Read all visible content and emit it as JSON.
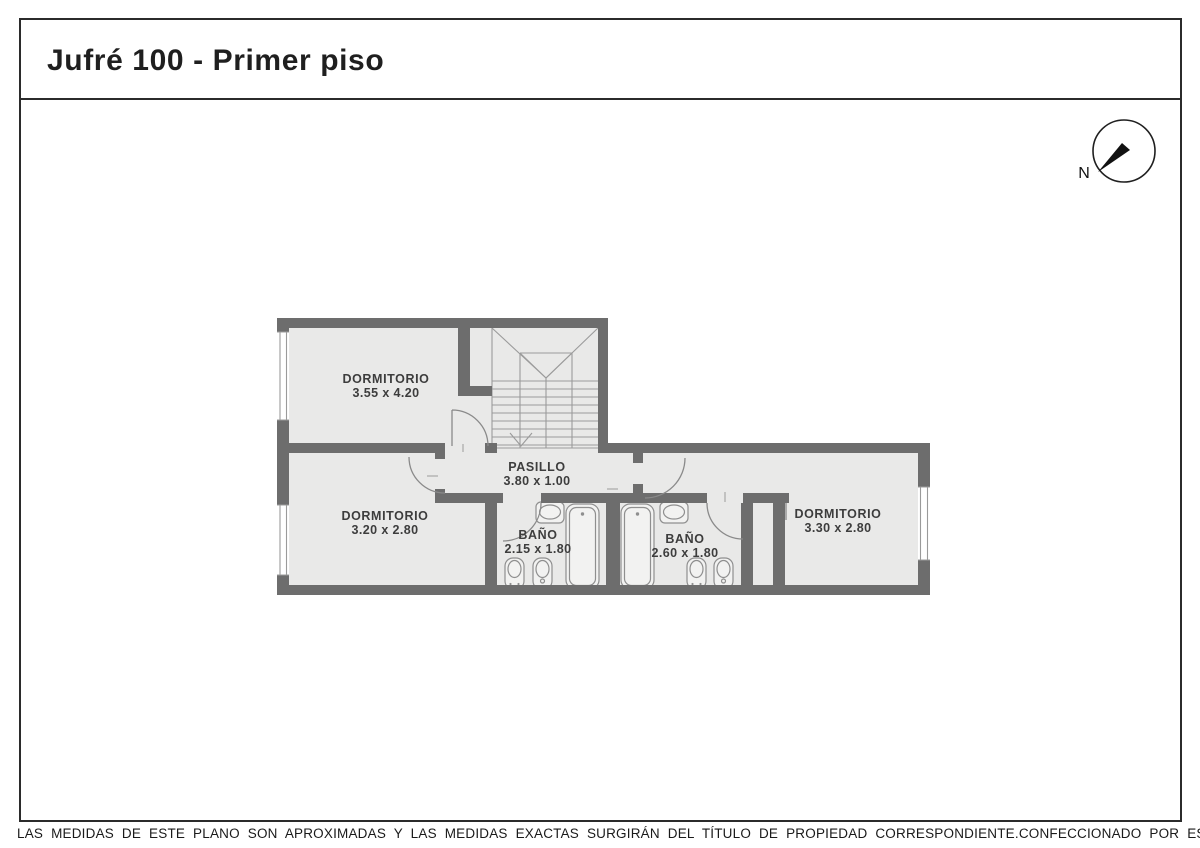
{
  "title": "Jufré 100 - Primer piso",
  "compass": {
    "north_label": "N"
  },
  "plan": {
    "rooms": {
      "dorm_top_left": {
        "name": "DORMITORIO",
        "dims": "3.55 x 4.20"
      },
      "dorm_bottom_left": {
        "name": "DORMITORIO",
        "dims": "3.20 x 2.80"
      },
      "pasillo": {
        "name": "PASILLO",
        "dims": "3.80 x 1.00"
      },
      "bano_left": {
        "name": "BAÑO",
        "dims": "2.15 x 1.80"
      },
      "bano_right": {
        "name": "BAÑO",
        "dims": "2.60 x 1.80"
      },
      "dorm_right": {
        "name": "DORMITORIO",
        "dims": "3.30 x 2.80"
      }
    },
    "colors": {
      "wall": "#6d6d6d",
      "floor": "#e9e9e8",
      "stair_line": "#9b9b9b",
      "door_line": "#8a8a8a",
      "fixture_line": "#8f8f8f",
      "text": "#3d3d3d",
      "frame": "#2b2b2b"
    }
  },
  "footer": {
    "disclaimer": "LAS MEDIDAS DE ESTE PLANO SON APROXIMADAS Y LAS MEDIDAS EXACTAS SURGIRÁN DEL TÍTULO DE PROPIEDAD CORRESPONDIENTE.",
    "credit": "CONFECCIONADO POR ESTUDIO NARTEX"
  }
}
